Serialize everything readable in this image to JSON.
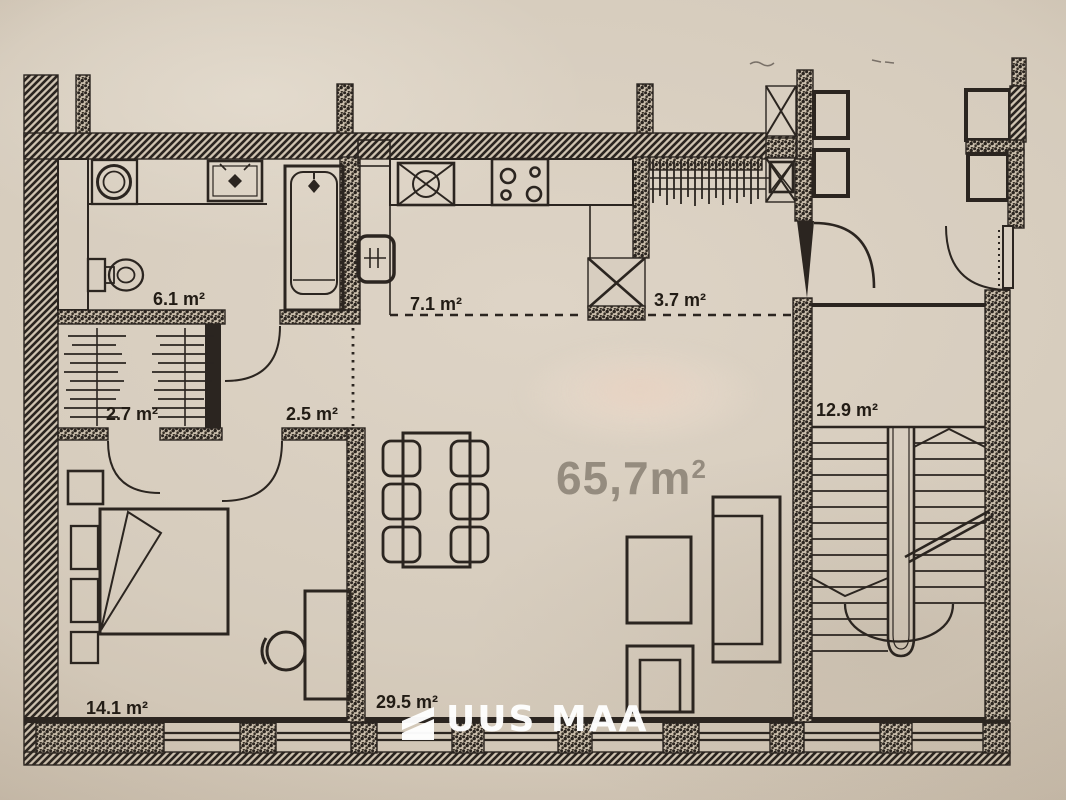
{
  "plan": {
    "title": "apartment-floor-plan",
    "rooms": [
      {
        "name": "bathroom",
        "area_label": "6.1 m²"
      },
      {
        "name": "kitchen",
        "area_label": "7.1 m²"
      },
      {
        "name": "entry-hall",
        "area_label": "3.7 m²"
      },
      {
        "name": "wardrobe",
        "area_label": "2.7 m²"
      },
      {
        "name": "hall",
        "area_label": "2.5 m²"
      },
      {
        "name": "stairwell",
        "area_label": "12.9 m²"
      },
      {
        "name": "bedroom",
        "area_label": "14.1 m²"
      },
      {
        "name": "living-room",
        "area_label": "29.5 m²"
      }
    ],
    "total_area": {
      "value": "65,7m",
      "superscript": "2"
    },
    "colors": {
      "paper": "#d6ccbd",
      "ink": "#2b2520",
      "muted_area_text": "#958c7f",
      "watermark": "#ffffff"
    }
  },
  "watermark": {
    "brand": "UUS MAA",
    "logo": "uus-maa-flag-icon"
  }
}
